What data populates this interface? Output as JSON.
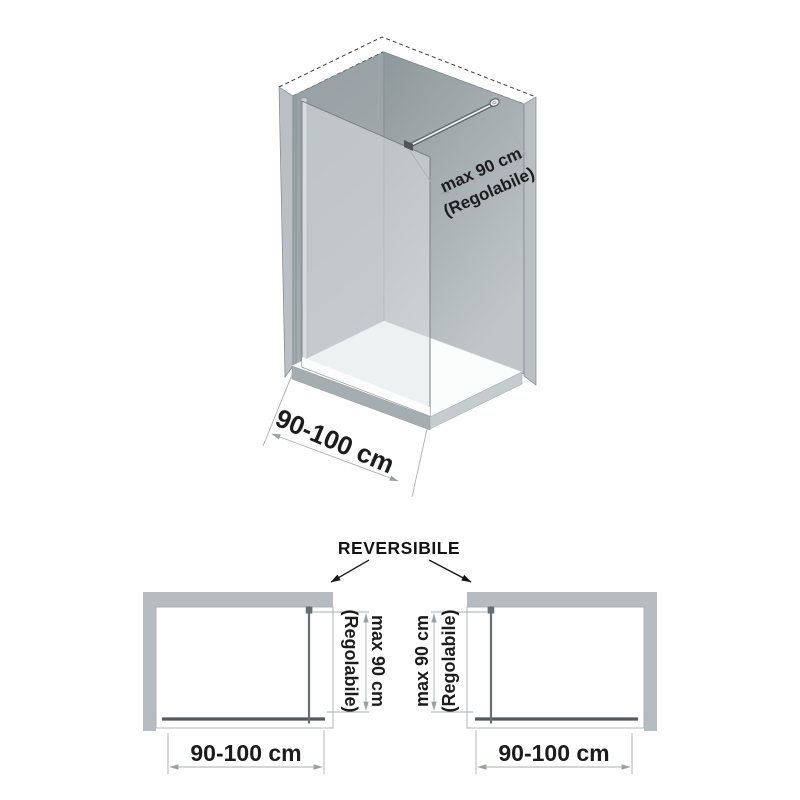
{
  "reversible_label": "REVERSIBILE",
  "iso_view": {
    "bar_dimension_line1": "max 90 cm",
    "bar_dimension_line2": "(Regolabile)",
    "width_dimension": "90-100 cm"
  },
  "plan_view_left": {
    "bar_dimension_line1": "max 90 cm",
    "bar_dimension_line2": "(Regolabile)",
    "width_dimension": "90-100 cm"
  },
  "plan_view_right": {
    "bar_dimension_line1": "max 90 cm",
    "bar_dimension_line2": "(Regolabile)",
    "width_dimension": "90-100 cm"
  },
  "colors": {
    "background": "#ffffff",
    "plan_wall": "#b6bcbf",
    "plan_panel": "#53595d",
    "plan_bar": "#676d71",
    "dim_line": "#a9afb2",
    "arrow_grey": "#9aa0a3",
    "text": "#1c1c1c",
    "iso_wall_left_top": "#969fa3",
    "iso_wall_left_bottom": "#a7aeb2",
    "iso_wall_back_top": "#8e979b",
    "iso_wall_back_bottom": "#c0c6c8",
    "iso_wall_edge": "#b9bfc2",
    "iso_profile": "#ced3d5",
    "iso_tray_top": "#fbfcfc",
    "iso_tray_side_left": "#a6adb0",
    "iso_tray_side_right": "#c6cbcd",
    "glass_tint": "rgba(225,230,232,0.5)",
    "bar_dark": "#60666a"
  }
}
